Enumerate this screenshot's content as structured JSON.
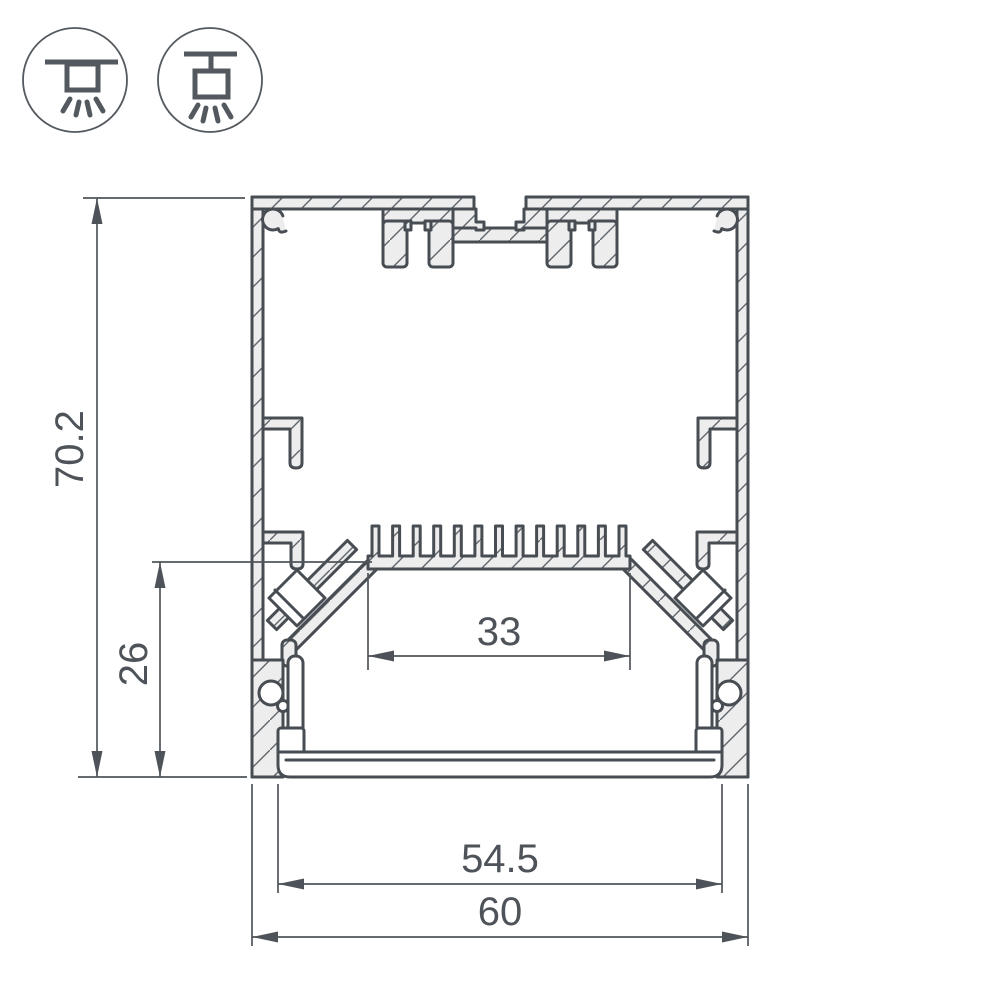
{
  "title": "Aluminium LED profile cross-section technical drawing",
  "icons": {
    "surface_mount": {
      "name": "surface-mount-light-icon",
      "meaning": "surface / ceiling mounted luminaire, light emitted downward"
    },
    "pendant_mount": {
      "name": "pendant-mount-light-icon",
      "meaning": "suspended (pendant) luminaire, light emitted downward"
    }
  },
  "dimensions": {
    "overall_height": {
      "value": "70.2"
    },
    "inner_height": {
      "value": "26"
    },
    "inner_width": {
      "value": "33"
    },
    "diffuser_width": {
      "value": "54.5"
    },
    "overall_width": {
      "value": "60"
    }
  },
  "colors": {
    "line": "#474d52",
    "dimension": "#4d5358",
    "aluminium_fill": "#ededee",
    "hatch_line": "#61676c",
    "background": "#ffffff"
  }
}
